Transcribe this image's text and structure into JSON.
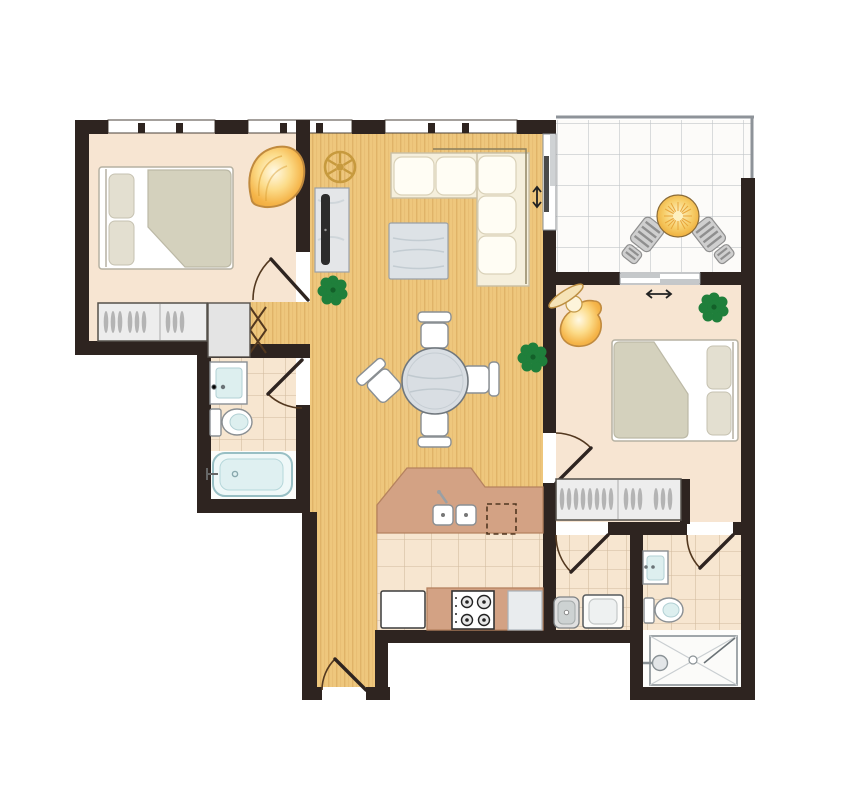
{
  "figure": {
    "kind": "apartment-floor-plan",
    "text_labels": [],
    "background": "#ffffff"
  },
  "palette": {
    "wall": "#2e2420",
    "wood": "#eec77d",
    "wood-grain": "#cf9c4e",
    "carpet": "#f7e5d2",
    "tile": "#f7e6d0",
    "tile-line": "#d2bb9e",
    "balcony-tile": "#fcfbf9",
    "balcony-tile-line": "#c2c6c9",
    "railing": "#8e9399",
    "counter": "#d3a284",
    "counter-edge": "#b5825f",
    "plant": "#1f7f3b",
    "plant-dark": "#136029",
    "lamp-glow": "#fbd36b",
    "lamp-edge": "#c08a3e",
    "sofa": "#f5efdc",
    "cushion": "#fffdf4",
    "furniture-gray": "#dde2e6",
    "steel": "#e0e0e0",
    "fixture-blue": "#ddefef",
    "door": "#53381f"
  },
  "rooms": [
    {
      "id": "bedroom-1",
      "floor": "carpet",
      "items": [
        "double-bed",
        "two-pillows",
        "duvet",
        "built-in-wardrobe",
        "ceiling-light",
        "hinged-door",
        "windows"
      ]
    },
    {
      "id": "hall-nook",
      "floor": "timber",
      "items": [
        "bifold-closet"
      ]
    },
    {
      "id": "bathroom-1",
      "floor": "tile",
      "items": [
        "vanity-basin",
        "toilet",
        "bathtub",
        "hinged-door"
      ]
    },
    {
      "id": "living-dining",
      "floor": "timber",
      "items": [
        "corner-sofa",
        "coffee-table",
        "tv-unit",
        "ceiling-fan",
        "round-dining-table",
        "four-dining-chairs",
        "potted-plant",
        "potted-plant",
        "sliding-balcony-door",
        "windows"
      ]
    },
    {
      "id": "kitchen",
      "floor": "tile",
      "items": [
        "l-shaped-counter",
        "double-sink",
        "dishwasher-outline",
        "fridge",
        "gas-cooktop",
        "counter-appliance"
      ]
    },
    {
      "id": "hallway",
      "floor": "timber",
      "items": [
        "entry-door"
      ]
    },
    {
      "id": "laundry",
      "floor": "tile",
      "items": [
        "laundry-sink",
        "washing-machine",
        "hinged-door"
      ]
    },
    {
      "id": "bedroom-2",
      "floor": "carpet",
      "items": [
        "double-bed",
        "two-pillows",
        "duvet",
        "built-in-wardrobe",
        "table-lamp",
        "potted-plant",
        "hinged-door",
        "sliding-balcony-door"
      ]
    },
    {
      "id": "ensuite",
      "floor": "tile",
      "items": [
        "vanity-basin",
        "toilet",
        "shower",
        "hinged-door"
      ]
    },
    {
      "id": "balcony",
      "floor": "outdoor-tile",
      "items": [
        "round-table",
        "two-striped-chairs",
        "railing"
      ]
    }
  ]
}
